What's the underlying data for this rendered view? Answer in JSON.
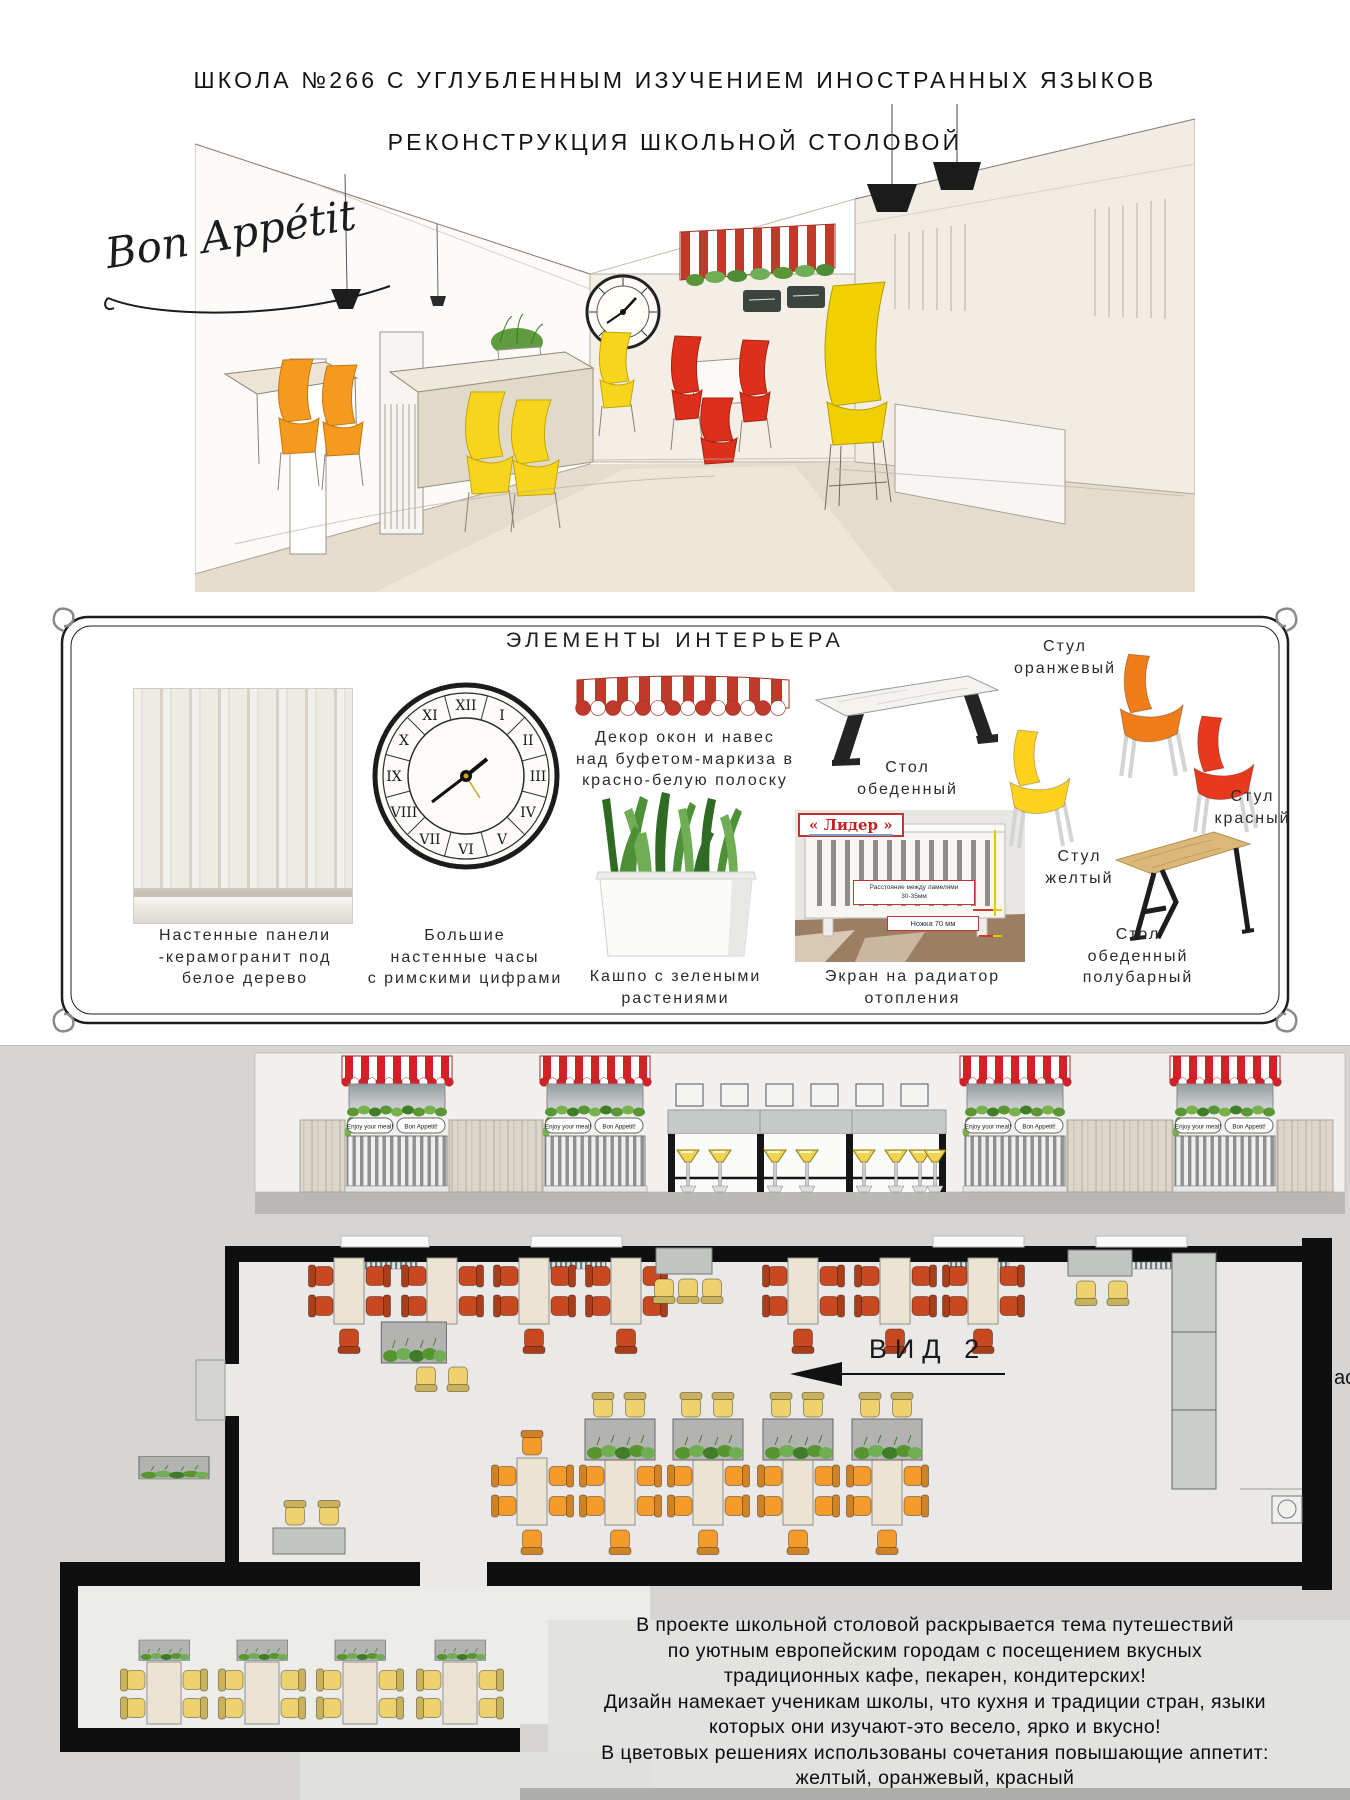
{
  "title": {
    "line1": "ШКОЛА №266 С УГЛУБЛЕННЫМ ИЗУЧЕНИЕМ ИНОСТРАННЫХ ЯЗЫКОВ",
    "line2": "РЕКОНСТРУКЦИЯ ШКОЛЬНОЙ СТОЛОВОЙ"
  },
  "sketch": {
    "script_text": "Bon Appétit"
  },
  "board": {
    "heading": "ЭЛЕМЕНТЫ ИНТЕРЬЕРА",
    "captions": {
      "wall_panels": "Настенные панели\n-керамогранит под\nбелое дерево",
      "clock": "Большие\nнастенные часы\nс римскими цифрами",
      "awning": "Декор окон и навес\nнад буфетом-маркиза в\nкрасно-белую полоску",
      "planter": "Кашпо с зелеными\nрастениями",
      "dining_table": "Стол\nобеденный",
      "radiator": "Экран на радиатор\nотопления",
      "chair_orange": "Стул\nоранжевый",
      "chair_red": "Стул\nкрасный",
      "chair_yellow": "Стул\nжелтый",
      "bar_table": "Стол\nобеденный\nполубарный"
    },
    "radiator_labels": {
      "brand": "« Лидер »",
      "note1": "Расстояние между ламелями\n30-35мм",
      "note2": "Ножка 70 мм"
    },
    "clock_numerals": [
      "XII",
      "I",
      "II",
      "III",
      "IV",
      "V",
      "VI",
      "VII",
      "VIII",
      "IX",
      "X",
      "XI"
    ]
  },
  "elevation": {
    "sign_left": "Enjoy your meal!",
    "sign_right": "Bon Appetit!"
  },
  "plan": {
    "view_label": "ВИД 2",
    "edge_text": "ас"
  },
  "description": {
    "text": "В проекте школьной столовой раскрывается тема путешествий\nпо уютным европейским городам с посещением вкусных\nтрадиционных кафе, пекарен, кондитерских!\nДизайн намекает ученикам школы, что кухня и традиции стран, языки\nкоторых они изучают-это весело, ярко и вкусно!\nВ цветовых решениях использованы сочетания повышающие аппетит:\nжелтый, оранжевый, красный"
  },
  "colors": {
    "awning_red": "#c0392b",
    "chair_orange": "#f07d1a",
    "chair_yellow": "#ffd21e",
    "chair_red": "#e8391c",
    "plan_red": "#c8491f",
    "plan_orange": "#f49b2c",
    "plan_yellow": "#eed26e"
  }
}
